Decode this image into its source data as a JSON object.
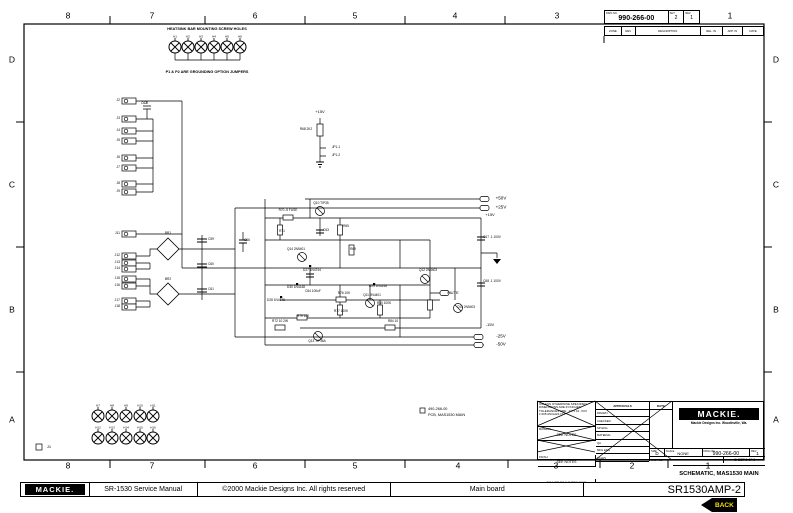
{
  "page": {
    "bg": "#ffffff",
    "ink": "#000000"
  },
  "border": {
    "top_numbers": [
      {
        "t": "8",
        "x": 68
      },
      {
        "t": "7",
        "x": 152
      },
      {
        "t": "6",
        "x": 255
      },
      {
        "t": "5",
        "x": 355
      },
      {
        "t": "4",
        "x": 455
      },
      {
        "t": "3",
        "x": 557
      },
      {
        "t": "1",
        "x": 730
      }
    ],
    "bottom_numbers": [
      {
        "t": "8",
        "x": 68
      },
      {
        "t": "7",
        "x": 152
      },
      {
        "t": "6",
        "x": 255
      },
      {
        "t": "5",
        "x": 355
      },
      {
        "t": "4",
        "x": 458
      },
      {
        "t": "3",
        "x": 556
      },
      {
        "t": "2",
        "x": 632
      },
      {
        "t": "1",
        "x": 708
      }
    ],
    "left_letters": [
      {
        "t": "D",
        "y": 60
      },
      {
        "t": "C",
        "y": 185
      },
      {
        "t": "B",
        "y": 310
      },
      {
        "t": "A",
        "y": 420
      }
    ],
    "right_letters": [
      {
        "t": "D",
        "y": 60
      },
      {
        "t": "C",
        "y": 185
      },
      {
        "t": "B",
        "y": 310
      },
      {
        "t": "A",
        "y": 420
      }
    ]
  },
  "dwg_box": {
    "dwg_no_label": "DWG NO.",
    "dwg_no": "990-266-00",
    "sheet_label": "SHT",
    "sheet": "2",
    "rev_label": "REV",
    "rev": "1"
  },
  "revision_table": {
    "headers": [
      "ZONE",
      "REV",
      "DESCRIPTION",
      "REL. IN",
      "APP. IN",
      "DATE"
    ]
  },
  "notes": {
    "heatsink": "HEATSINK BAR MOUNTING SCREW HOLES",
    "jumpers": "P1 & P2 ARE GROUNDING OPTION JUMPERS",
    "pcb_line1": "490-266-00",
    "pcb_line2": "PCB, MAS1530 MAIN"
  },
  "schematic": {
    "labels": [
      {
        "t": "+50V",
        "x": 501,
        "y": 199,
        "s": 4.5
      },
      {
        "t": "+25V",
        "x": 501,
        "y": 208,
        "s": 4.5
      },
      {
        "t": "+15V",
        "x": 490,
        "y": 215,
        "s": 4
      },
      {
        "t": "-15V",
        "x": 490,
        "y": 325,
        "s": 4
      },
      {
        "t": "-25V",
        "x": 501,
        "y": 337,
        "s": 4.5
      },
      {
        "t": "-50V",
        "x": 501,
        "y": 345,
        "s": 4.5
      },
      {
        "t": "+15V",
        "x": 320,
        "y": 112,
        "s": 4
      },
      {
        "t": "R68 2K2",
        "x": 306,
        "y": 130,
        "s": 3.2
      },
      {
        "t": "JP1-1",
        "x": 336,
        "y": 148,
        "s": 3.2
      },
      {
        "t": "JP1-2",
        "x": 336,
        "y": 156,
        "s": 3.2
      },
      {
        "t": "MUTE",
        "x": 453,
        "y": 293,
        "s": 4
      },
      {
        "t": "R70 .5 FUSE",
        "x": 288,
        "y": 211,
        "s": 3.2
      },
      {
        "t": "Q10 TIP35",
        "x": 321,
        "y": 204,
        "s": 3.2
      },
      {
        "t": "R71",
        "x": 282,
        "y": 232,
        "s": 3.2
      },
      {
        "t": "C63",
        "x": 326,
        "y": 231,
        "s": 3.2
      },
      {
        "t": "R65",
        "x": 346,
        "y": 227,
        "s": 3.2
      },
      {
        "t": "R69",
        "x": 353,
        "y": 250,
        "s": 3.2
      },
      {
        "t": "Q14 2N5401",
        "x": 296,
        "y": 250,
        "s": 3.2
      },
      {
        "t": "D27 1N4744",
        "x": 312,
        "y": 271,
        "s": 3.2
      },
      {
        "t": "C66",
        "x": 247,
        "y": 241,
        "s": 3.2
      },
      {
        "t": "D30 1N4148",
        "x": 296,
        "y": 288,
        "s": 3.2
      },
      {
        "t": "D28 1N4148",
        "x": 276,
        "y": 301,
        "s": 3.2
      },
      {
        "t": "C64 100uF",
        "x": 313,
        "y": 292,
        "s": 3.2
      },
      {
        "t": "R76 10K",
        "x": 344,
        "y": 294,
        "s": 3.2
      },
      {
        "t": "Q11 2N4401",
        "x": 372,
        "y": 296,
        "s": 3.2
      },
      {
        "t": "R77 100K",
        "x": 341,
        "y": 312,
        "s": 3.2
      },
      {
        "t": "R72 10 2W",
        "x": 280,
        "y": 322,
        "s": 3.2
      },
      {
        "t": "R79 100",
        "x": 303,
        "y": 317,
        "s": 3.2
      },
      {
        "t": "Q13 TIP36A",
        "x": 317,
        "y": 342,
        "s": 3.2
      },
      {
        "t": "D29 1N4148",
        "x": 378,
        "y": 287,
        "s": 3.2
      },
      {
        "t": "R80 100K",
        "x": 384,
        "y": 304,
        "s": 3.2
      },
      {
        "t": "R84 10",
        "x": 393,
        "y": 322,
        "s": 3.2
      },
      {
        "t": "Q12 2N4403",
        "x": 428,
        "y": 271,
        "s": 3.2
      },
      {
        "t": "Q15 2N5403",
        "x": 466,
        "y": 308,
        "s": 3.2
      },
      {
        "t": "C67 .1 100V",
        "x": 492,
        "y": 238,
        "s": 3.2
      },
      {
        "t": "C68 .1 100V",
        "x": 492,
        "y": 282,
        "s": 3.2
      },
      {
        "t": "C62",
        "x": 144,
        "y": 104,
        "s": 3.2
      },
      {
        "t": "BR1",
        "x": 168,
        "y": 234,
        "s": 3.2
      },
      {
        "t": "BR2",
        "x": 168,
        "y": 280,
        "s": 3.2
      },
      {
        "t": "C59",
        "x": 211,
        "y": 240,
        "s": 3.2
      },
      {
        "t": "C60",
        "x": 211,
        "y": 265,
        "s": 3.2
      },
      {
        "t": "C61",
        "x": 211,
        "y": 290,
        "s": 3.2
      },
      {
        "t": "J1",
        "x": 49,
        "y": 447,
        "s": 4
      }
    ],
    "connector_groups": [
      {
        "x": 122,
        "rows": [
          {
            "y": 101,
            "l": "J2"
          },
          {
            "y": 119,
            "l": "J3"
          },
          {
            "y": 131,
            "l": "J4"
          },
          {
            "y": 141,
            "l": "J5"
          },
          {
            "y": 158,
            "l": "J6"
          },
          {
            "y": 168,
            "l": "J7"
          },
          {
            "y": 184,
            "l": "J8"
          },
          {
            "y": 192,
            "l": "J9"
          }
        ]
      },
      {
        "x": 122,
        "rows": [
          {
            "y": 234,
            "l": "J11"
          },
          {
            "y": 256,
            "l": "J12"
          },
          {
            "y": 263,
            "l": "J13"
          },
          {
            "y": 269,
            "l": "J14"
          },
          {
            "y": 279,
            "l": "J15"
          },
          {
            "y": 286,
            "l": "J16"
          },
          {
            "y": 301,
            "l": "J17"
          },
          {
            "y": 307,
            "l": "J18"
          }
        ]
      }
    ],
    "top_holes": {
      "y": 47,
      "label_y": 37,
      "xs": [
        175,
        188,
        201,
        214,
        227,
        240
      ],
      "labels": [
        "H1",
        "H2",
        "H3",
        "H4",
        "H5",
        "H6"
      ]
    },
    "bottom_holes": [
      {
        "y": 416,
        "label_y": 406,
        "xs": [
          98,
          112,
          126,
          140,
          153
        ],
        "labels": [
          "H7",
          "H8",
          "H9",
          "H10",
          "H11"
        ]
      },
      {
        "y": 438,
        "label_y": 428,
        "xs": [
          98,
          112,
          126,
          140,
          153
        ],
        "labels": [
          "H12",
          "H13",
          "H14",
          "H15",
          "H16"
        ]
      }
    ]
  },
  "title_block": {
    "logo": "MACKIE.",
    "company": "Mackie Designs Inc.   Woodinville, Wa.",
    "title": "SCHEMATIC, MAS1530 MAIN",
    "tolerance_note": "UNLESS OTHERWISE SPECIFIED DIMENSIONS ARE IN INCHES TOLERANCES ARE: .XX ±.01  .XXX ±.005  ANGLES ±1°",
    "material_label": "MATERIAL:",
    "material": "SEE NOTES",
    "finish_label": "FINISH:",
    "finish": "SEE NOTES",
    "no_scale": "DO NOT SCALE DRAWING",
    "approvals_header": "APPROVALS",
    "date_header": "DATE",
    "approval_rows": [
      "DRAWN",
      "CHECKED",
      "SP ENG",
      "MATERIAL",
      "QA",
      "MFG ENG",
      "SALES"
    ],
    "size_label": "SIZE",
    "size": "D",
    "scale_label": "SCALE",
    "scale": "NONE",
    "dwg_no_label": "DWG NO.",
    "dwg_no": "990-266-00",
    "rev_label": "REV",
    "rev": "1",
    "cad_label": "CAD FILE",
    "sheet": "SHEET 2 OF 2"
  },
  "footer": {
    "logo": "MACKIE.",
    "manual": "SR-1530 Service Manual",
    "copyright": "©2000 Mackie Designs Inc. All rights reserved",
    "board": "Main board",
    "doc_id": "SR1530AMP-2",
    "back_label": "BACK",
    "back_bg": "#000000",
    "back_fg": "#f0e10a"
  }
}
